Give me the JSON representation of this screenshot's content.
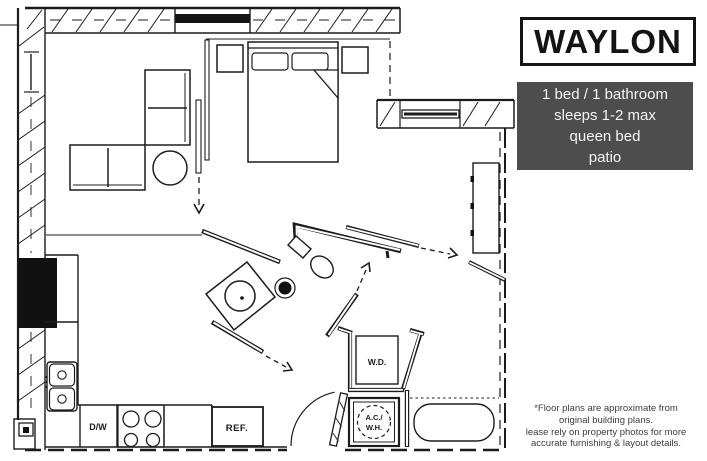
{
  "title_box": {
    "label": "WAYLON"
  },
  "info_box": {
    "bg_color": "#4d4d4d",
    "text_color": "#f5f5f5",
    "lines": [
      "1 bed / 1 bathroom",
      "sleeps 1-2 max",
      "queen bed",
      "patio"
    ]
  },
  "disclaimer": {
    "line1": "*Floor plans are approximate from",
    "line2": "original building plans.",
    "line3": "lease rely on property photos for more",
    "line4": "accurate furnishing & layout details."
  },
  "floor_plan": {
    "line_color": "#1c1c1c",
    "labels": {
      "dishwasher": "D/W",
      "refrigerator": "REF.",
      "washer_dryer": "W.D.",
      "ac_line1": "A.C./",
      "ac_line2": "W.H."
    }
  }
}
